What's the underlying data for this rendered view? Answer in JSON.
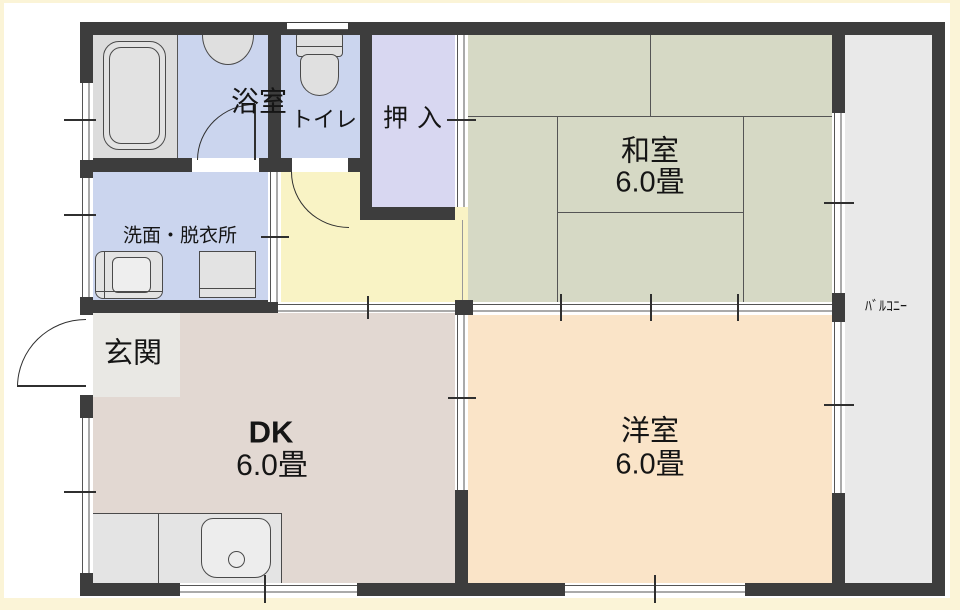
{
  "floorplan": {
    "wall_color": "#3d3d3d",
    "frame_color": "#fbf4d7",
    "window_line_color": "#555555",
    "rooms": {
      "bathroom": {
        "label": "浴室",
        "color": "#cbd5ee"
      },
      "bathtub_area": {
        "color": "#dcdcdc"
      },
      "toilet": {
        "label": "トイレ",
        "color": "#cbd5ee"
      },
      "closet": {
        "label": "押入",
        "color": "#d8d7f1"
      },
      "hallway": {
        "color": "#f9f3c5"
      },
      "washroom": {
        "label": "洗面・脱衣所",
        "color": "#cbd5ee"
      },
      "entrance": {
        "label": "玄関",
        "color": "#e9e8e4"
      },
      "dining_kitchen": {
        "label": "DK",
        "size": "6.0畳",
        "color": "#e2d8d2"
      },
      "japanese_room": {
        "label": "和室",
        "size": "6.0畳",
        "color": "#d6d9c5"
      },
      "western_room": {
        "label": "洋室",
        "size": "6.0畳",
        "color": "#fae4c8"
      },
      "balcony": {
        "label": "ﾊﾞﾙｺﾆｰ",
        "color": "#e9e9e9"
      }
    }
  }
}
